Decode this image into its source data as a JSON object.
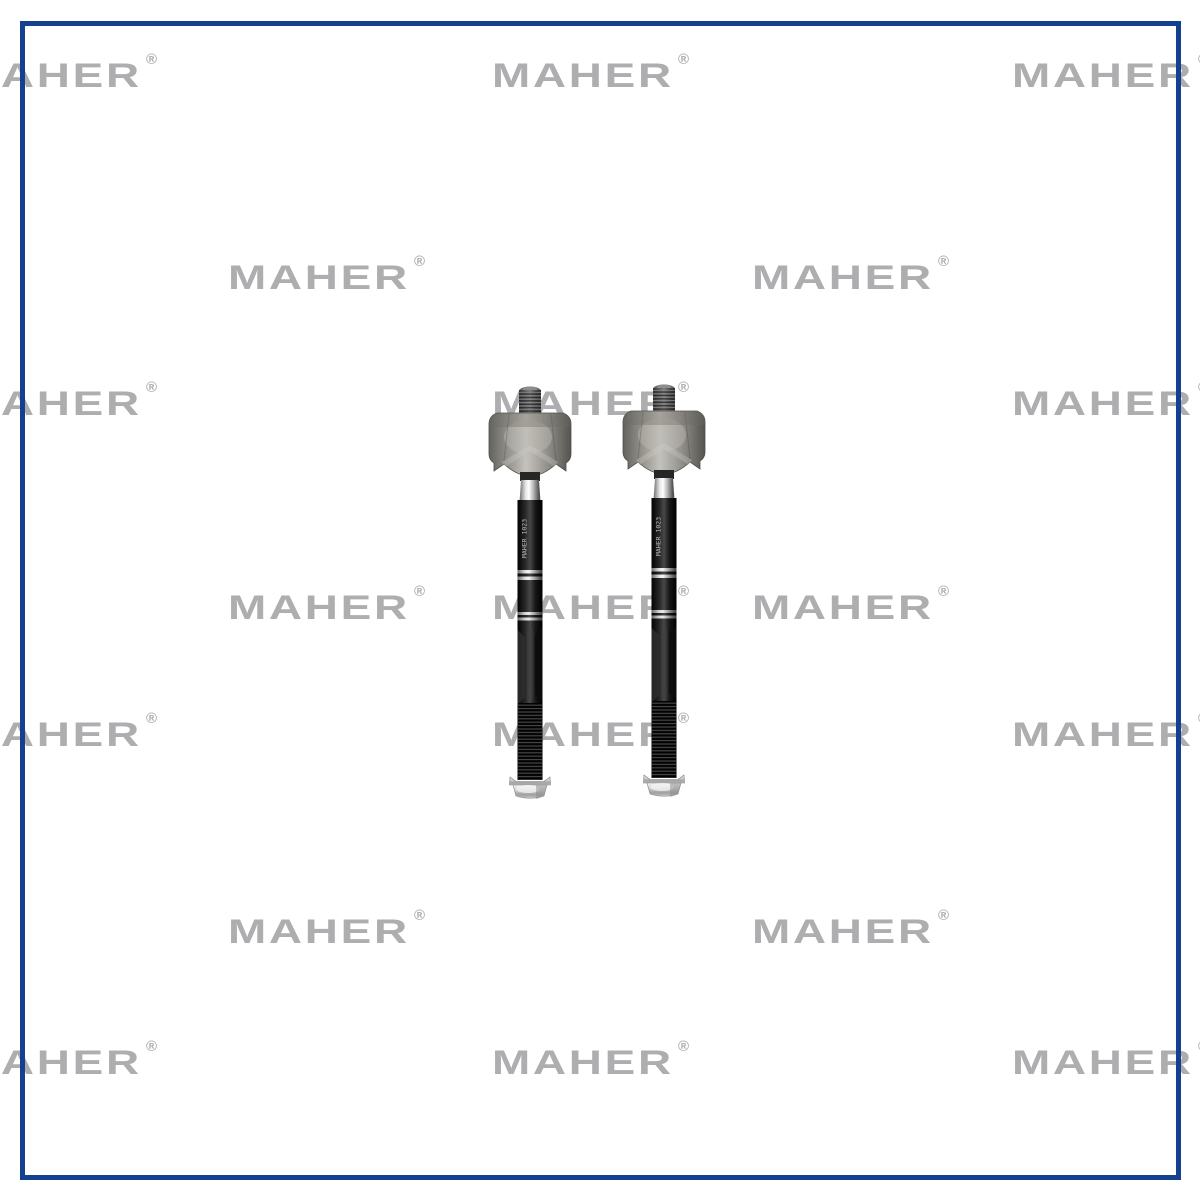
{
  "image": {
    "background_color": "#ffffff",
    "width": 1200,
    "height": 1200
  },
  "border_frame": {
    "color": "#14418f",
    "thickness_px": 5,
    "left": 20,
    "top": 21,
    "width": 1161,
    "height": 1159
  },
  "watermark": {
    "text": "MAHER",
    "registered_mark": "®",
    "color": "#aeaeb0",
    "positions": [
      {
        "x": -40,
        "y": 59
      },
      {
        "x": 492,
        "y": 59
      },
      {
        "x": 1012,
        "y": 59
      },
      {
        "x": 228,
        "y": 261
      },
      {
        "x": 752,
        "y": 261
      },
      {
        "x": -40,
        "y": 387
      },
      {
        "x": 492,
        "y": 387
      },
      {
        "x": 1012,
        "y": 387
      },
      {
        "x": 228,
        "y": 591
      },
      {
        "x": 492,
        "y": 591
      },
      {
        "x": 752,
        "y": 591
      },
      {
        "x": -40,
        "y": 718
      },
      {
        "x": 492,
        "y": 718
      },
      {
        "x": 1012,
        "y": 718
      },
      {
        "x": 228,
        "y": 915
      },
      {
        "x": 752,
        "y": 915
      },
      {
        "x": -40,
        "y": 1046
      },
      {
        "x": 492,
        "y": 1046
      },
      {
        "x": 1012,
        "y": 1046
      }
    ]
  },
  "product": {
    "item_count": 2,
    "shaft_marking": "MAHER 1023",
    "rod_positions": [
      {
        "x": 530,
        "y": 385
      },
      {
        "x": 664,
        "y": 383
      }
    ],
    "colors": {
      "housing_metal": "#a5a39c",
      "shaft_black": "#1a1a1a",
      "chrome": "#e8e8e8",
      "stud_gray": "#5a5a5a",
      "hex_end_silver": "#c9c9c9"
    }
  }
}
